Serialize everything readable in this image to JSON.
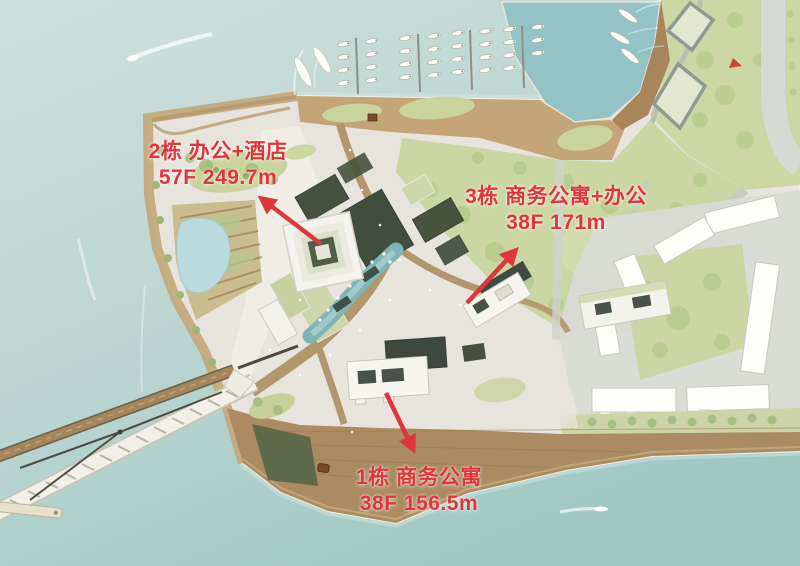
{
  "annotations": {
    "building_2": {
      "line1": "2栋  办公+酒店",
      "line2": "57F  249.7m"
    },
    "building_3": {
      "line1": "3栋  商务公寓+办公",
      "line2": "38F  171m"
    },
    "building_1": {
      "line1": "1栋  商务公寓",
      "line2": "38F  156.5m"
    }
  },
  "colors": {
    "annotation_red": "#e0353b",
    "water": "#c7dbd7",
    "harbor_water": "#93c3c4",
    "sand_pier": "#c3a577",
    "wood_deck": "#aa8b62",
    "lawn": "#cbd7a2",
    "plaza": "#e7e4dd",
    "building_white": "#f6f5f0",
    "podium_dark": "#46523f"
  }
}
